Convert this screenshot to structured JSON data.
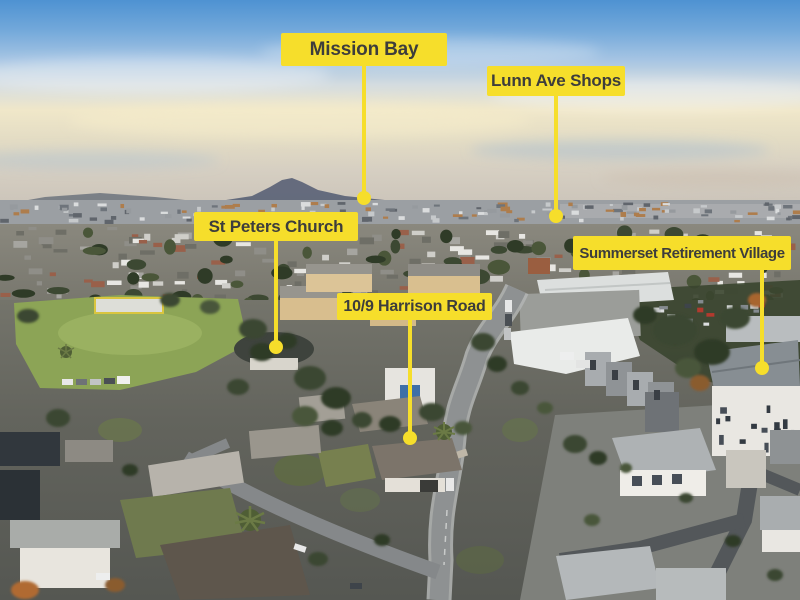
{
  "annotations": {
    "label_bg_color": "#F6DE2B",
    "label_text_color": "#3D3D3C",
    "labels": [
      {
        "id": "mission-bay",
        "text": "Mission Bay"
      },
      {
        "id": "lunn-ave-shops",
        "text": "Lunn Ave Shops"
      },
      {
        "id": "st-peters-church",
        "text": "St Peters Church"
      },
      {
        "id": "summerset",
        "text": "Summerset Retirement Village"
      },
      {
        "id": "harrison-road",
        "text": "10/9 Harrison Road"
      }
    ]
  }
}
